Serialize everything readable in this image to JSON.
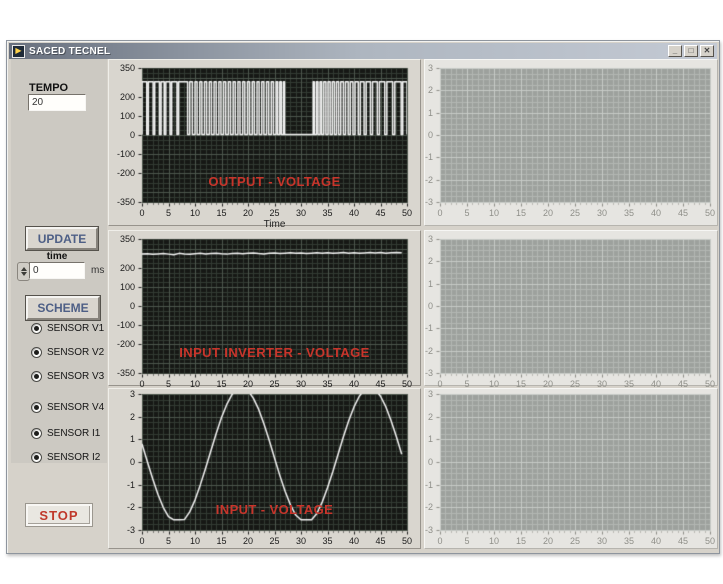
{
  "window": {
    "title": "SACED TECNEL",
    "icon": "labview-run-arrow-icon",
    "controls": {
      "minimize": "_",
      "maximize": "□",
      "close": "✕"
    }
  },
  "sidebar": {
    "tempo_label": "TEMPO",
    "tempo_value": "20",
    "update_button": "UPDATE",
    "time_label": "time",
    "time_value": "0",
    "time_unit": "ms",
    "scheme_button": "SCHEME",
    "sensors": [
      {
        "label": "SENSOR V1",
        "selected": true
      },
      {
        "label": "SENSOR V2",
        "selected": true
      },
      {
        "label": "SENSOR V3",
        "selected": true
      },
      {
        "label": "SENSOR V4",
        "selected": true
      },
      {
        "label": "SENSOR I1",
        "selected": true
      },
      {
        "label": "SENSOR I2",
        "selected": true
      }
    ],
    "stop_button": "STOP"
  },
  "colors": {
    "chart_title_red": "#c8352b",
    "waveform_white": "#f4f4f4",
    "dark_plot_bg": "#161815",
    "gray_plot_bg": "#9da19d"
  },
  "chart_data": [
    {
      "type": "line",
      "title": "OUTPUT - VOLTAGE",
      "xlabel": "Time",
      "xlim": [
        0,
        50
      ],
      "ylim": [
        -350,
        350
      ],
      "x_tick_labels": [
        "0",
        "5",
        "10",
        "15",
        "20",
        "25",
        "30",
        "35",
        "40",
        "45",
        "50"
      ],
      "y_tick_labels": [
        "350",
        "200",
        "100",
        "0",
        "-100",
        "-200",
        "-350"
      ],
      "y_tick_values": [
        350,
        200,
        100,
        0,
        -100,
        -200,
        -350
      ],
      "grid": {
        "minor_x": 1,
        "minor_y": 25,
        "major_x": 5,
        "major_y": 100,
        "on": true
      },
      "theme": "dark",
      "series": [
        {
          "name": "output-voltage-pwm",
          "encoding": "pwm",
          "low": 2,
          "high": 278,
          "pulses": [
            [
              0,
              0.9
            ],
            [
              1.2,
              2.1
            ],
            [
              2.4,
              3.3
            ],
            [
              3.6,
              4.2
            ],
            [
              4.5,
              5.3
            ],
            [
              5.6,
              6.6
            ],
            [
              6.9,
              8.6
            ],
            [
              9.0,
              9.5
            ],
            [
              10.0,
              10.4
            ],
            [
              10.9,
              11.3
            ],
            [
              11.8,
              12.2
            ],
            [
              12.7,
              13.1
            ],
            [
              13.6,
              14.0
            ],
            [
              14.5,
              14.9
            ],
            [
              15.4,
              15.8
            ],
            [
              16.3,
              16.7
            ],
            [
              17.2,
              17.6
            ],
            [
              18.1,
              18.5
            ],
            [
              19.0,
              19.4
            ],
            [
              19.9,
              20.3
            ],
            [
              20.8,
              21.2
            ],
            [
              21.7,
              22.1
            ],
            [
              22.6,
              23.0
            ],
            [
              23.5,
              23.9
            ],
            [
              24.4,
              24.8
            ],
            [
              25.3,
              25.6
            ],
            [
              26.0,
              26.3
            ],
            [
              26.7,
              26.9
            ],
            [
              32.3,
              32.5
            ],
            [
              32.9,
              33.2
            ],
            [
              33.6,
              33.9
            ],
            [
              34.3,
              34.7
            ],
            [
              35.1,
              35.5
            ],
            [
              35.9,
              36.3
            ],
            [
              36.7,
              37.1
            ],
            [
              37.5,
              38.0
            ],
            [
              38.4,
              38.9
            ],
            [
              39.3,
              39.8
            ],
            [
              40.2,
              40.8
            ],
            [
              41.2,
              41.9
            ],
            [
              42.3,
              43.1
            ],
            [
              43.5,
              44.4
            ],
            [
              44.8,
              45.8
            ],
            [
              46.2,
              47.3
            ],
            [
              47.7,
              48.9
            ],
            [
              49.2,
              50
            ]
          ]
        }
      ]
    },
    {
      "type": "line",
      "title": "INPUT INVERTER - VOLTAGE",
      "xlabel": "",
      "xlim": [
        0,
        50
      ],
      "ylim": [
        -350,
        350
      ],
      "x_tick_labels": [
        "0",
        "5",
        "10",
        "15",
        "20",
        "25",
        "30",
        "35",
        "40",
        "45",
        "50"
      ],
      "y_tick_labels": [
        "350",
        "200",
        "100",
        "0",
        "-100",
        "-200",
        "-350"
      ],
      "y_tick_values": [
        350,
        200,
        100,
        0,
        -100,
        -200,
        -350
      ],
      "grid": {
        "minor_x": 1,
        "minor_y": 25,
        "major_x": 5,
        "major_y": 100,
        "on": true
      },
      "theme": "dark",
      "series": [
        {
          "name": "inverter-voltage",
          "encoding": "values",
          "x_start": 0,
          "x_step": 1,
          "values": [
            271,
            273,
            270,
            272,
            274,
            271,
            268,
            275,
            272,
            270,
            273,
            275,
            272,
            274,
            276,
            273,
            271,
            274,
            276,
            273,
            275,
            277,
            274,
            272,
            275,
            277,
            274,
            276,
            278,
            275,
            277,
            274,
            276,
            278,
            276,
            278,
            275,
            277,
            279,
            276,
            278,
            275,
            277,
            279,
            277,
            279,
            276,
            278,
            280,
            278
          ]
        }
      ]
    },
    {
      "type": "line",
      "title": "INPUT - VOLTAGE",
      "xlabel": "",
      "xlim": [
        0,
        50
      ],
      "ylim": [
        -3,
        3
      ],
      "x_tick_labels": [
        "0",
        "5",
        "10",
        "15",
        "20",
        "25",
        "30",
        "35",
        "40",
        "45",
        "50"
      ],
      "y_tick_labels": [
        "3",
        "2",
        "1",
        "0",
        "-1",
        "-2",
        "-3"
      ],
      "y_tick_values": [
        3,
        2,
        1,
        0,
        -1,
        -2,
        -3
      ],
      "grid": {
        "minor_x": 1,
        "minor_y": 0.25,
        "major_x": 5,
        "major_y": 1,
        "on": true
      },
      "theme": "dark",
      "series": [
        {
          "name": "input-voltage-sine",
          "encoding": "values",
          "x_start": 0,
          "x_step": 1,
          "values": [
            0.8,
            0.02,
            -0.73,
            -1.42,
            -2.0,
            -2.41,
            -2.55,
            -2.55,
            -2.54,
            -2.2,
            -1.68,
            -1.01,
            -0.28,
            0.5,
            1.26,
            1.96,
            2.54,
            2.98,
            3.24,
            3.3,
            3.15,
            2.82,
            2.33,
            1.69,
            0.96,
            0.18,
            -0.59,
            -1.29,
            -1.89,
            -2.34,
            -2.55,
            -2.55,
            -2.55,
            -2.27,
            -1.77,
            -1.14,
            -0.43,
            0.34,
            1.11,
            1.82,
            2.43,
            2.9,
            3.2,
            3.3,
            3.2,
            2.9,
            2.44,
            1.82,
            1.11,
            0.34
          ]
        }
      ]
    },
    {
      "type": "line",
      "title": "",
      "xlabel": "",
      "xlim": [
        0,
        50
      ],
      "ylim": [
        -3,
        3
      ],
      "x_tick_labels": [
        "0",
        "5",
        "10",
        "15",
        "20",
        "25",
        "30",
        "35",
        "40",
        "45",
        "50"
      ],
      "y_tick_labels": [
        "3",
        "2",
        "1",
        "0",
        "-1",
        "-2",
        "-3"
      ],
      "y_tick_values": [
        3,
        2,
        1,
        0,
        -1,
        -2,
        -3
      ],
      "grid": {
        "minor_x": 1,
        "minor_y": 0.25,
        "major_x": 5,
        "major_y": 1,
        "on": true
      },
      "theme": "gray",
      "series": []
    },
    {
      "type": "line",
      "title": "",
      "xlabel": "",
      "xlim": [
        0,
        50
      ],
      "ylim": [
        -3,
        3
      ],
      "x_tick_labels": [
        "0",
        "5",
        "10",
        "15",
        "20",
        "25",
        "30",
        "35",
        "40",
        "45",
        "50"
      ],
      "y_tick_labels": [
        "3",
        "2",
        "1",
        "0",
        "-1",
        "-2",
        "-3"
      ],
      "y_tick_values": [
        3,
        2,
        1,
        0,
        -1,
        -2,
        -3
      ],
      "grid": {
        "minor_x": 1,
        "minor_y": 0.25,
        "major_x": 5,
        "major_y": 1,
        "on": true
      },
      "theme": "gray",
      "series": []
    },
    {
      "type": "line",
      "title": "",
      "xlabel": "",
      "xlim": [
        0,
        50
      ],
      "ylim": [
        -3,
        3
      ],
      "x_tick_labels": [
        "0",
        "5",
        "10",
        "15",
        "20",
        "25",
        "30",
        "35",
        "40",
        "45",
        "50"
      ],
      "y_tick_labels": [
        "3",
        "2",
        "1",
        "0",
        "-1",
        "-2",
        "-3"
      ],
      "y_tick_values": [
        3,
        2,
        1,
        0,
        -1,
        -2,
        -3
      ],
      "grid": {
        "minor_x": 1,
        "minor_y": 0.25,
        "major_x": 5,
        "major_y": 1,
        "on": true
      },
      "theme": "gray",
      "series": []
    }
  ]
}
